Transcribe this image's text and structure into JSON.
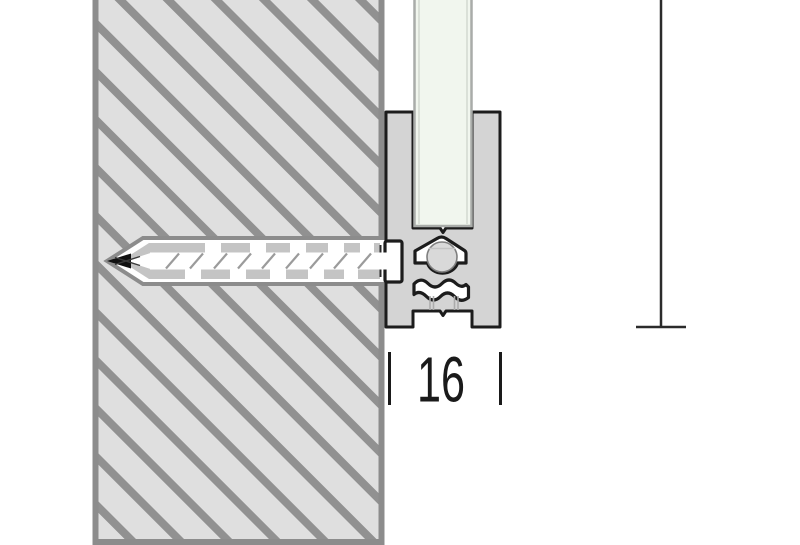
{
  "diagram": {
    "type": "technical-cross-section",
    "dimension": {
      "width_label": "16"
    },
    "colors": {
      "background": "#ffffff",
      "wall_fill": "#dfdfdf",
      "wall_hatch": "#919191",
      "wall_border": "#8c8c8c",
      "hole_fill": "#ffffff",
      "anchor_fill": "#c4c4c4",
      "profile_fill": "#d4d4d4",
      "outline": "#1c1c1c",
      "screw_fill": "#ffffff",
      "screw_head_fill": "#d9d9d9",
      "thread_color": "#9b9b9b",
      "glass_fill": "#f1f6ee",
      "glass_edge": "#a9aca9",
      "dim_color": "#1a1a1a"
    }
  }
}
